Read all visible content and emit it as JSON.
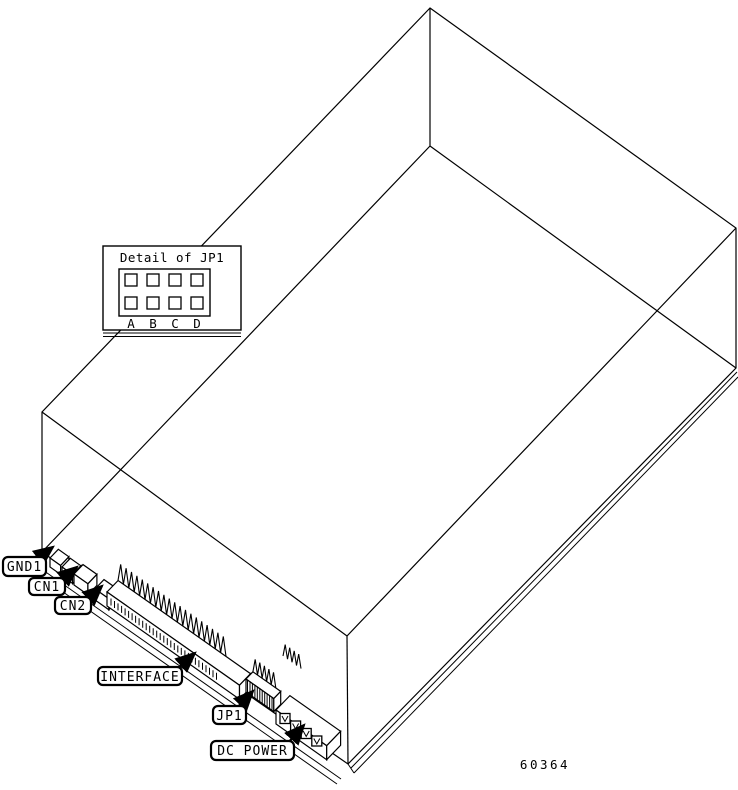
{
  "diagram": {
    "description": "Isometric line drawing of a disk drive unit showing rear connector locations",
    "part_number": "60364",
    "detail_inset": {
      "title": "Detail of JP1",
      "jumper_columns": [
        "A",
        "B",
        "C",
        "D"
      ],
      "jumper_rows": 2
    },
    "callouts": {
      "gnd1": "GND1",
      "cn1": "CN1",
      "cn2": "CN2",
      "interface": "INTERFACE",
      "jp1": "JP1",
      "dc_power": "DC POWER"
    },
    "colors": {
      "line": "#000000",
      "background": "#ffffff"
    }
  }
}
